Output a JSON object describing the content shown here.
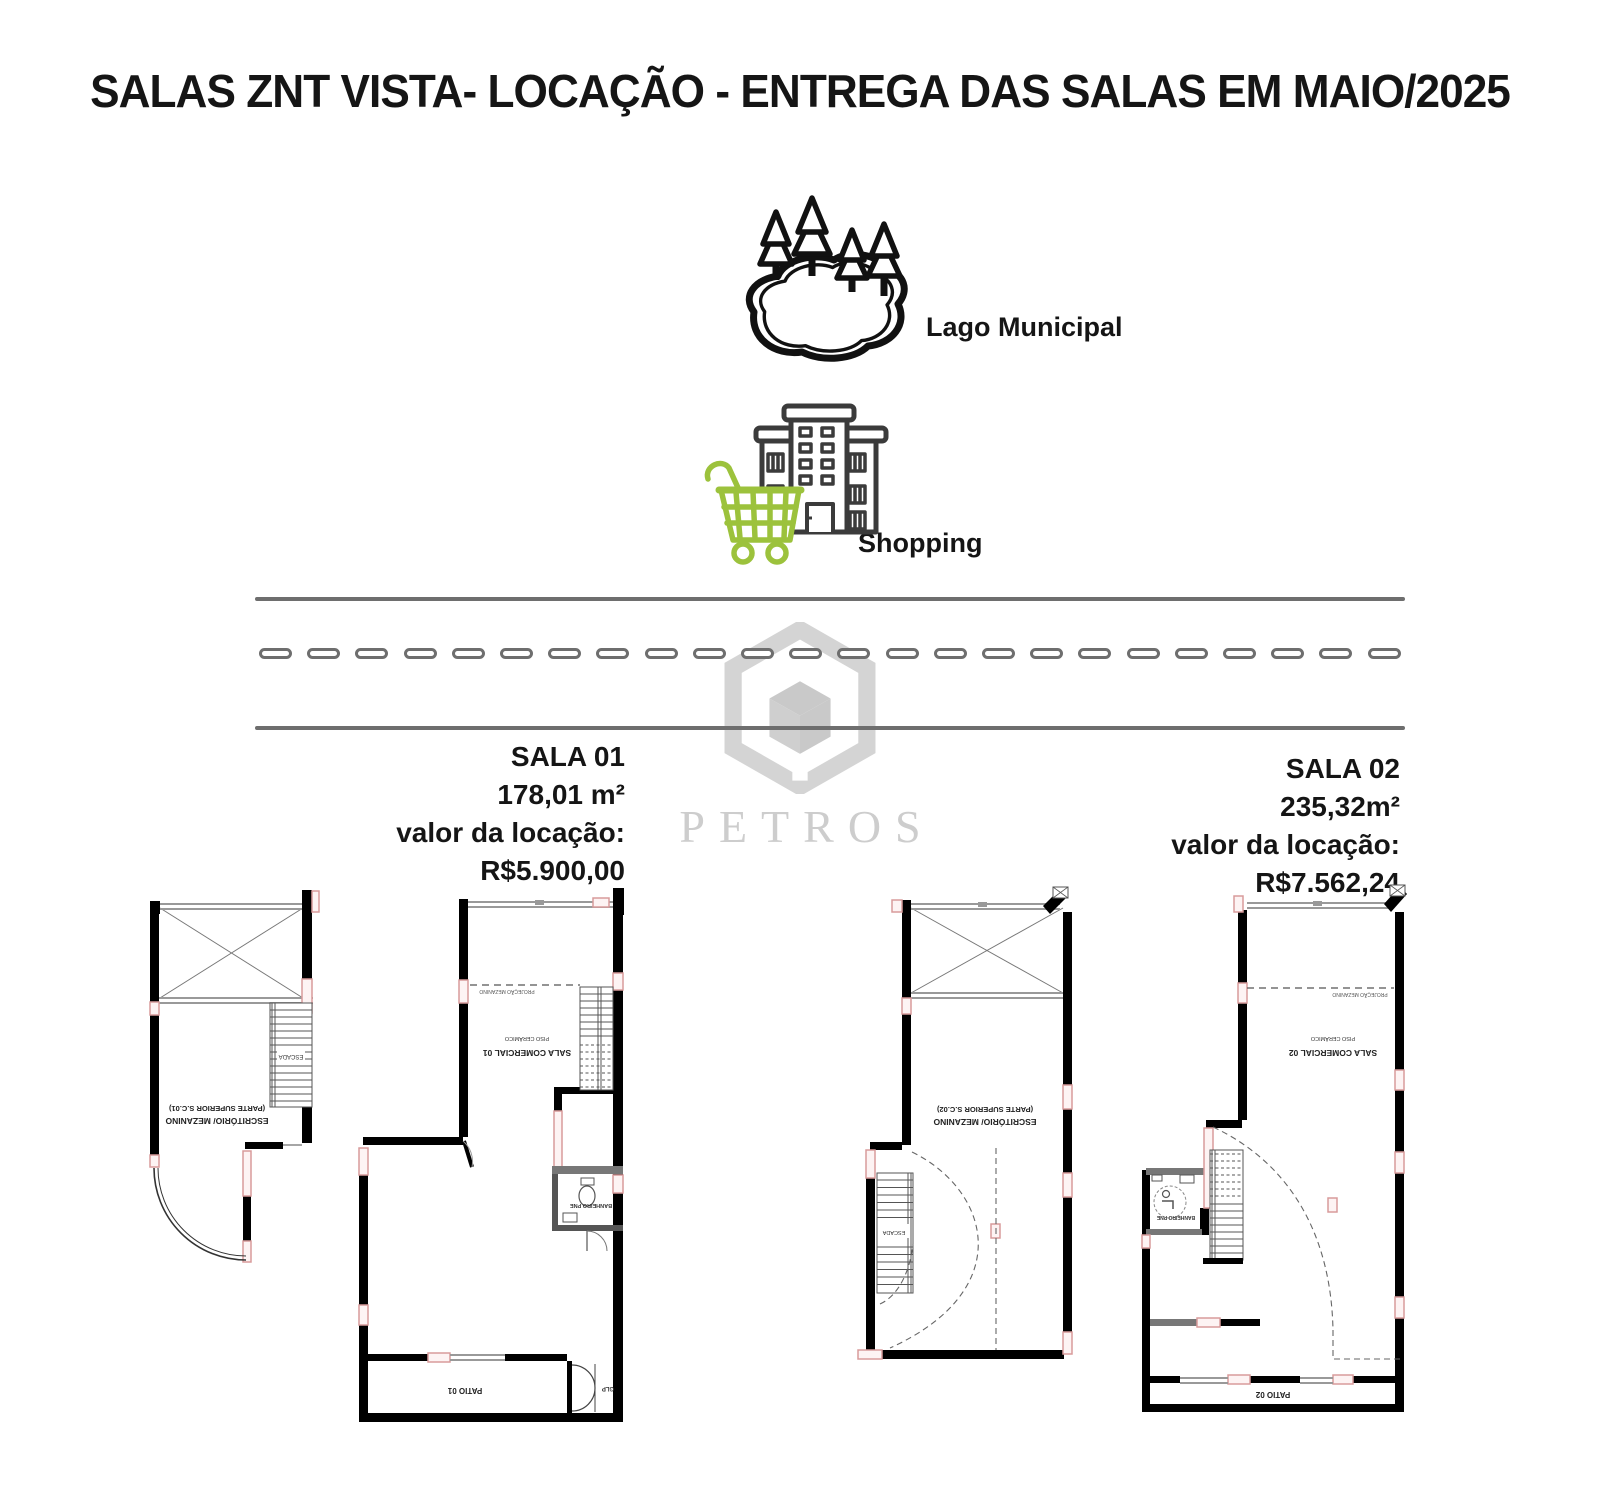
{
  "title": "SALAS ZNT VISTA- LOCAÇÃO - ENTREGA DAS SALAS EM MAIO/2025",
  "landmarks": {
    "lake": {
      "label": "Lago Municipal",
      "icon": "lake-with-pine-trees-icon"
    },
    "shopping": {
      "label": "Shopping",
      "icon": "building-with-shopping-cart-icon"
    }
  },
  "road": {
    "style": "two solid lines with outlined dashed center line"
  },
  "watermark": {
    "brand": "PETROS",
    "icon": "hexagon-cube-logo"
  },
  "units": [
    {
      "name": "SALA 01",
      "area": "178,01 m²",
      "rent": "valor da locação: R$5.900,00"
    },
    {
      "name": "SALA 02",
      "area": "235,32m²",
      "rent": "valor da locação: R$7.562,24"
    }
  ],
  "floor_plans": [
    {
      "id": "mezanino-sc01",
      "labels": {
        "room_line1": "ESCRITÓRIO/ MEZANINO",
        "room_line2": "(PARTE SUPERIOR S.C.01)",
        "stairs": "ESCADA"
      }
    },
    {
      "id": "sala-comercial-01",
      "labels": {
        "room": "SALA COMERCIAL 01",
        "floor_note": "PISO CERÂMICO",
        "projection": "PROJEÇÃO MEZANINO",
        "bathroom": "BANHEIRO PNE",
        "patio": "PATIO 01",
        "gas": "GLP"
      }
    },
    {
      "id": "mezanino-sc02",
      "labels": {
        "room_line1": "ESCRITÓRIO/ MEZANINO",
        "room_line2": "(PARTE SUPERIOR S.C.02)",
        "stairs": "ESCADA"
      }
    },
    {
      "id": "sala-comercial-02",
      "labels": {
        "room": "SALA COMERCIAL 02",
        "floor_note": "PISO CERÂMICO",
        "projection": "PROJEÇÃO MEZANINO",
        "bathroom": "BANHEIRO PNE",
        "patio": "PATIO 02"
      }
    }
  ],
  "colors": {
    "cart_green": "#9cc23c",
    "building_gray": "#3b3b3b",
    "road_gray": "#6e6e6e",
    "watermark_gray": "#d4d4d4",
    "wall_black": "#000000",
    "opening_pink": "#d89b9b"
  }
}
